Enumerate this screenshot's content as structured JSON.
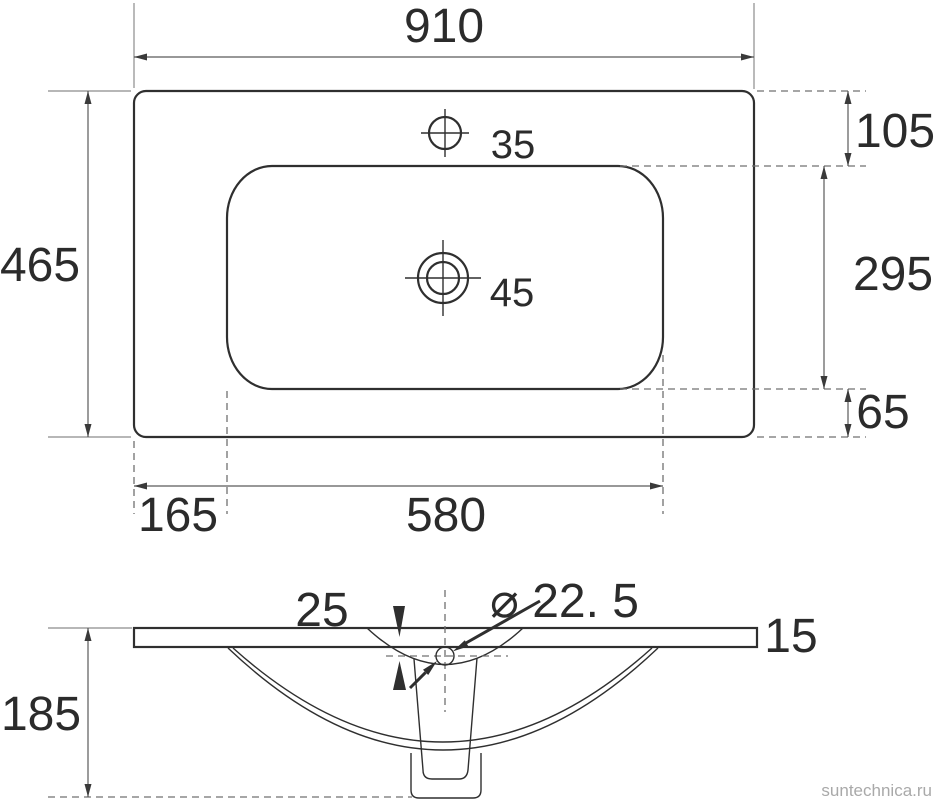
{
  "drawing": {
    "top_view": {
      "overall_width": "910",
      "overall_depth": "465",
      "faucet_hole_size": "35",
      "drain_hole_size": "45",
      "top_edge_to_basin": "105",
      "basin_front_to_back": "295",
      "basin_to_bottom_edge": "65",
      "left_edge_to_basin": "165",
      "basin_width": "580"
    },
    "front_view": {
      "overall_height": "185",
      "top_thickness": "15",
      "recess_depth": "25",
      "drain_diameter": "⌀ 22. 5"
    }
  },
  "colors": {
    "ink": "#2f2f2f",
    "dimension_line": "#5a5a5a",
    "extension_line": "#8c8c8c",
    "dashed_line": "#707070",
    "watermark": "#a9a9a9"
  },
  "watermark": "suntechnica.ru"
}
